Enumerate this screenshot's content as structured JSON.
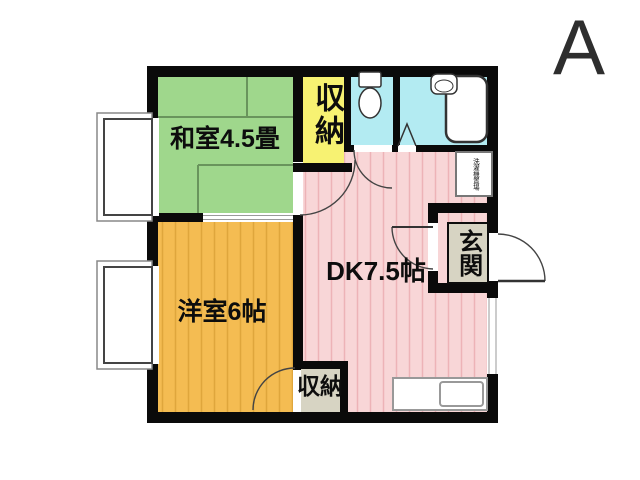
{
  "title_letter": "A",
  "labels": {
    "washitsu": "和室4.5畳",
    "yoshitsu": "洋室6帖",
    "dk": "DK7.5帖",
    "closet_top": "収納",
    "closet_bottom": "収納",
    "genkan": "玄関",
    "laundry": "洗濯機置場"
  },
  "colors": {
    "tatami_green": "#9fd78c",
    "wood_orange": "#f4bc52",
    "dk_pink": "#f8d6d7",
    "closet_yellow": "#f7f272",
    "wet_area_cyan": "#b3ebf2",
    "label_box_beige": "#d7d4c3",
    "wall_black": "#0a0a0a"
  }
}
